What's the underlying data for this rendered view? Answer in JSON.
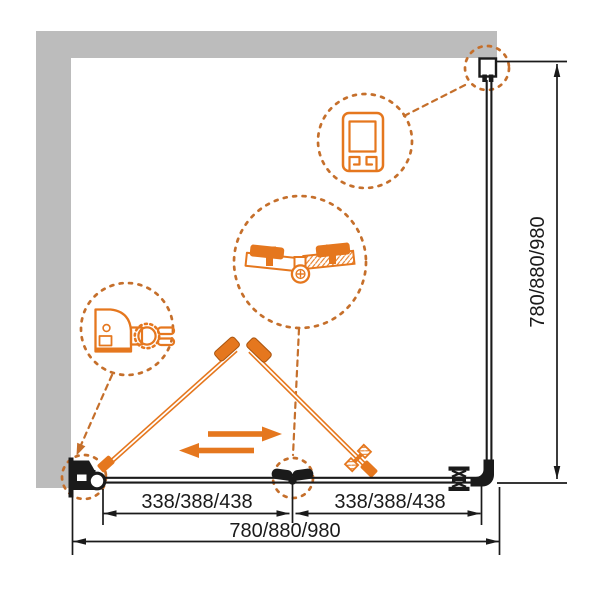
{
  "diagram": {
    "dimensions": {
      "left_panel": "338/388/438",
      "right_panel": "338/388/438",
      "total_width": "780/880/980",
      "side_depth": "780/880/980"
    },
    "icons": {
      "slide_direction_right": "arrow-right",
      "slide_direction_left": "arrow-left"
    },
    "colors": {
      "accent": "#E5771E",
      "callout": "#C56F2B",
      "wall": "#BCBCBC",
      "ink": "#1A1A1A",
      "bg": "#FFFFFF"
    }
  }
}
